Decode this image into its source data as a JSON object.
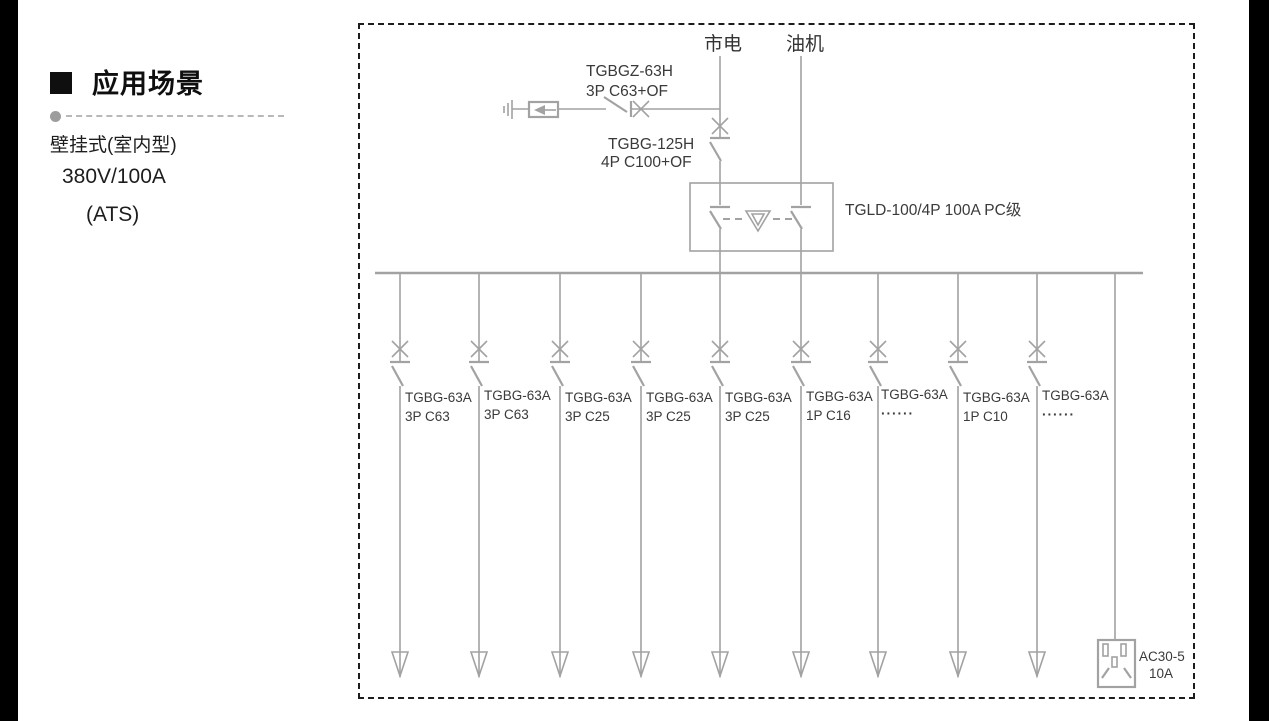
{
  "left_panel": {
    "heading": "应用场景",
    "line1": "壁挂式(室内型)",
    "line2": "380V/100A",
    "line3": "(ATS)"
  },
  "diagram": {
    "colors": {
      "line_gray": "#a2a2a2",
      "label_text": "#3a3a3a",
      "dashed_border": "#1c1c1c",
      "side_bars": "#000000"
    },
    "sources": {
      "mains": "市电",
      "generator": "油机"
    },
    "surge_branch": {
      "model": "TGBGZ-63H",
      "spec": "3P C63+OF"
    },
    "main_breaker": {
      "model": "TGBG-125H",
      "spec": "4P C100+OF"
    },
    "transfer_switch": {
      "label": "TGLD-100/4P 100A PC级"
    },
    "branches": [
      {
        "model": "TGBG-63A",
        "spec": "3P C63"
      },
      {
        "model": "TGBG-63A",
        "spec": "3P C63"
      },
      {
        "model": "TGBG-63A",
        "spec": "3P C25"
      },
      {
        "model": "TGBG-63A",
        "spec": "3P C25"
      },
      {
        "model": "TGBG-63A",
        "spec": "3P C25"
      },
      {
        "model": "TGBG-63A",
        "spec": "1P C16"
      },
      {
        "model": "TGBG-63A",
        "spec": "······"
      },
      {
        "model": "TGBG-63A",
        "spec": "1P C10"
      },
      {
        "model": "TGBG-63A",
        "spec": "······"
      }
    ],
    "socket": {
      "model": "AC30-5",
      "rating": "10A"
    }
  }
}
